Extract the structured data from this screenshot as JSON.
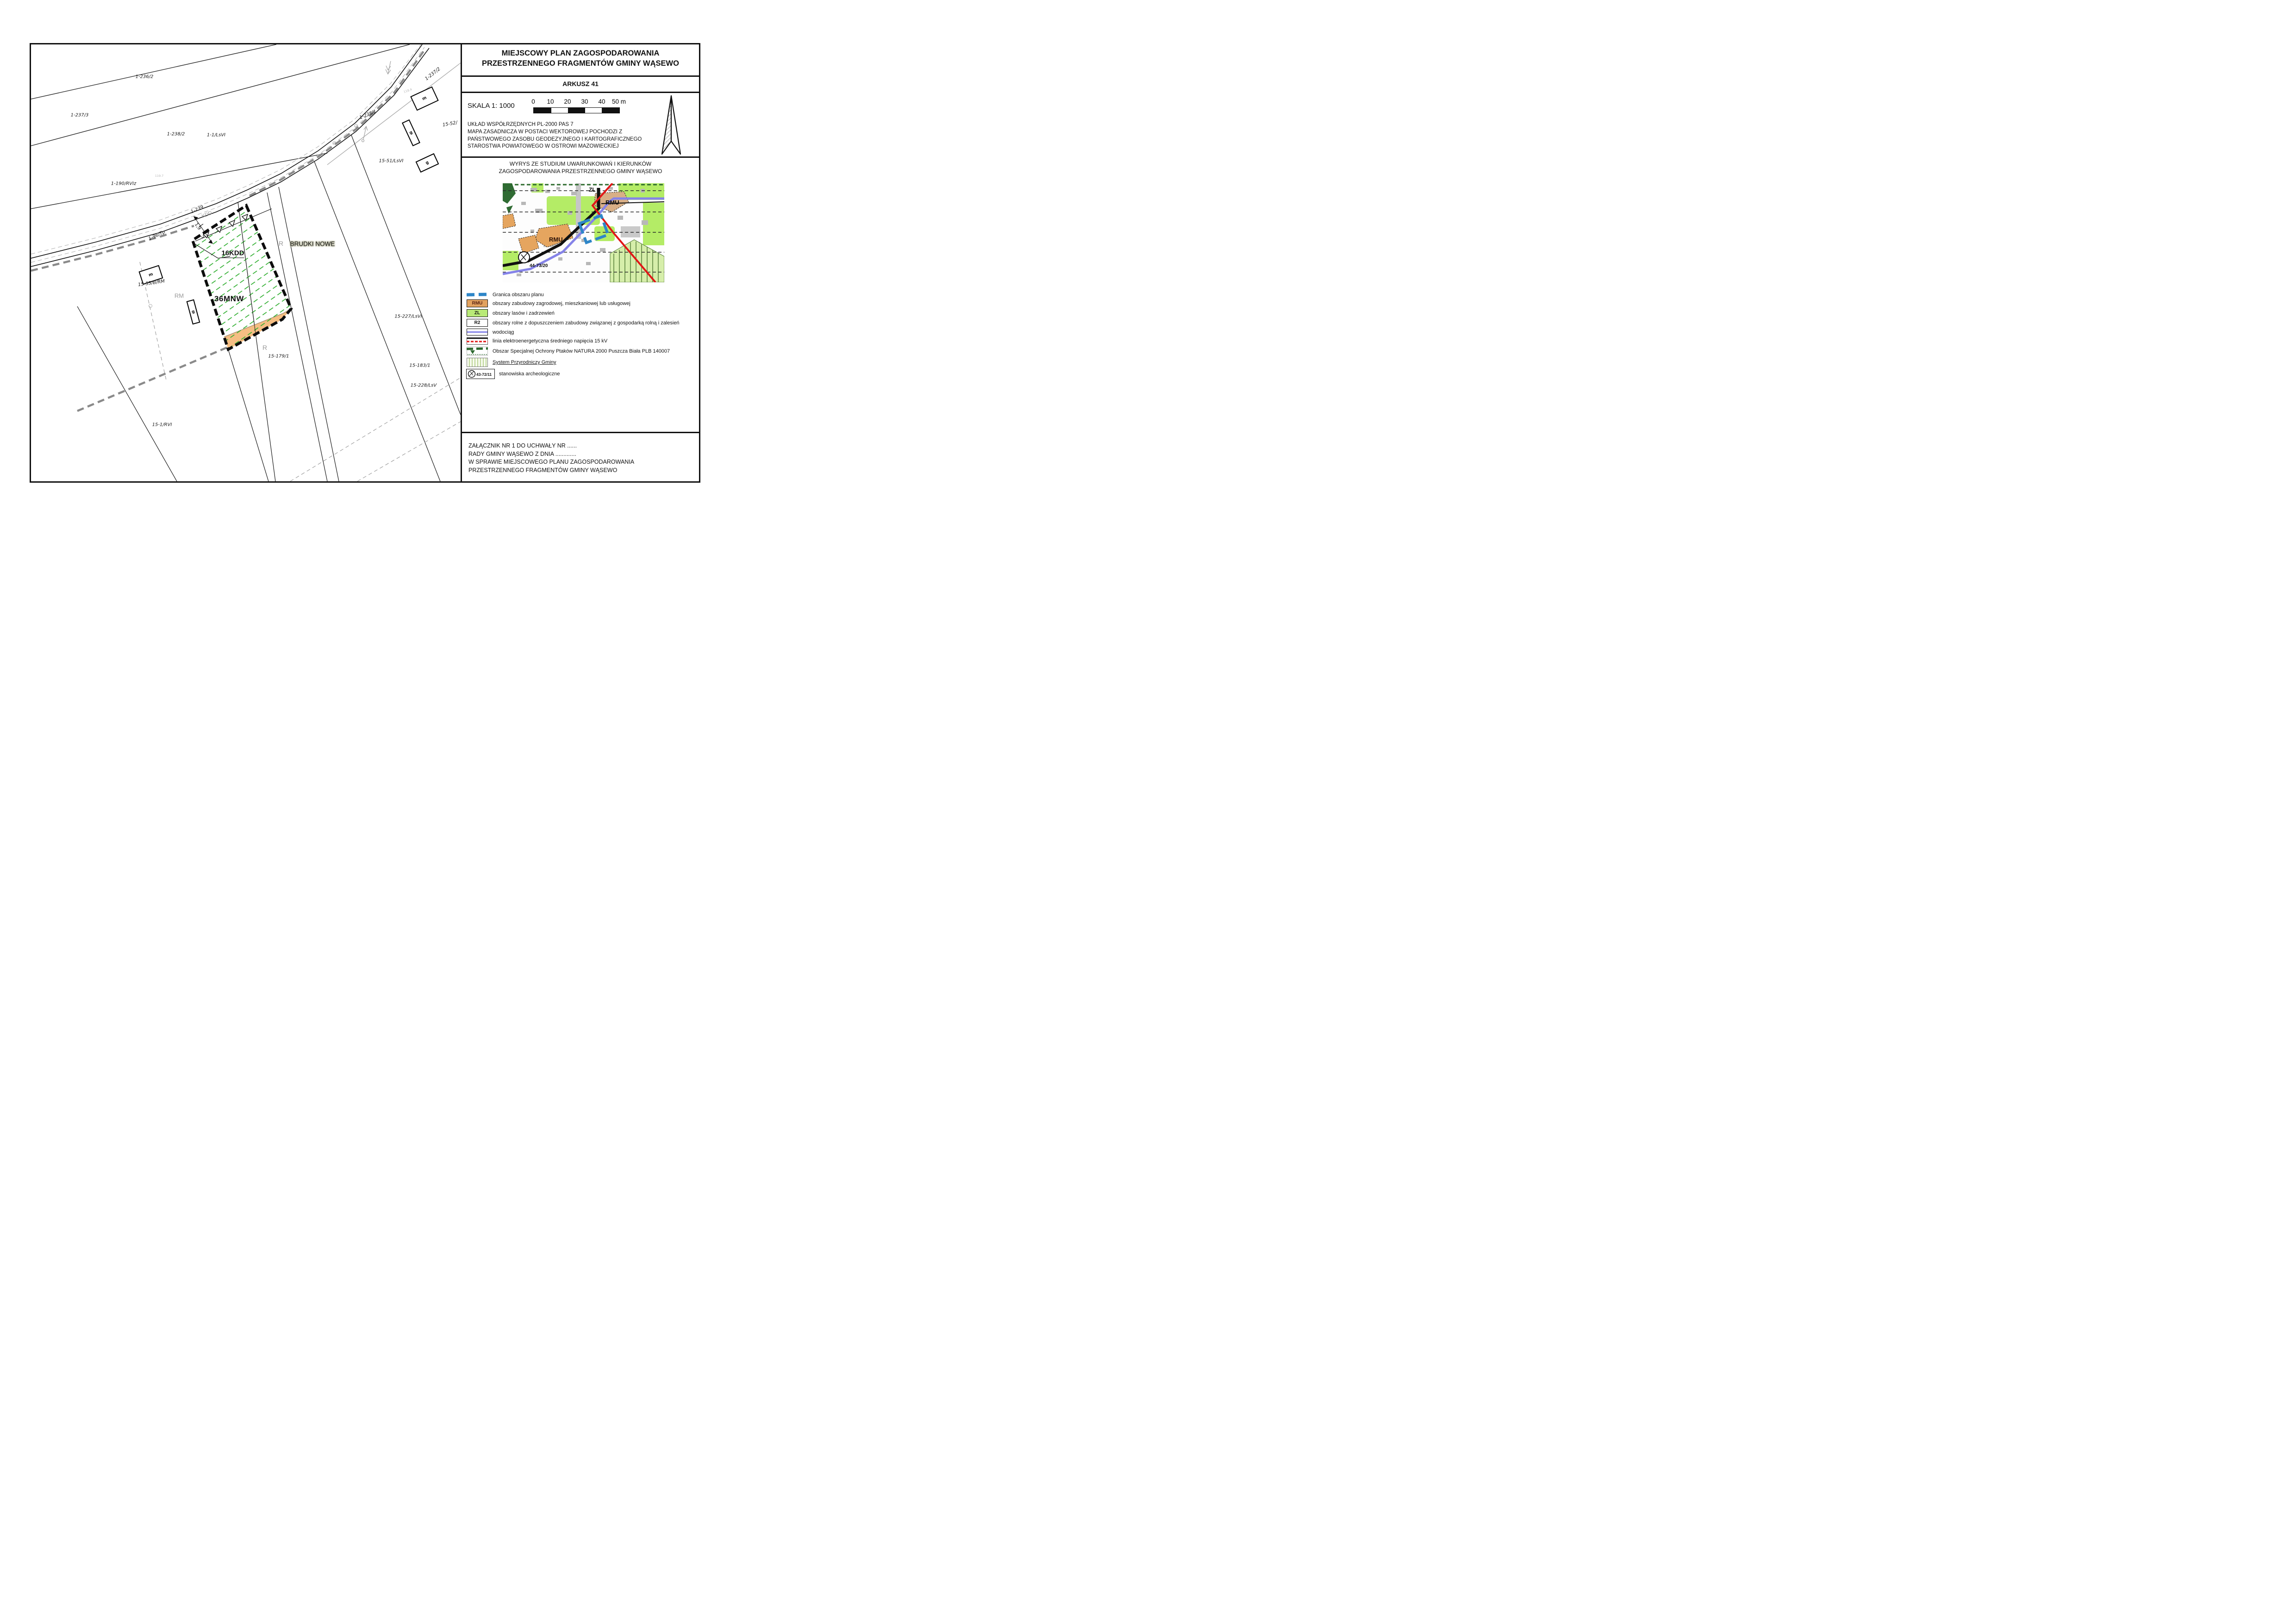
{
  "sheet": {
    "title_line1": "MIEJSCOWY PLAN ZAGOSPODAROWANIA",
    "title_line2": "PRZESTRZENNEGO FRAGMENTÓW GMINY WĄSEWO",
    "sheet_label": "ARKUSZ 41",
    "scale": {
      "label": "SKALA 1: 1000",
      "ticks": [
        "0",
        "10",
        "20",
        "30",
        "40",
        "50 m"
      ]
    },
    "source_lines": [
      "UKŁAD WSPÓŁRZĘDNYCH PL-2000 PAS 7",
      "MAPA ZASADNICZA W POSTACI WEKTOROWEJ POCHODZI Z",
      "PAŃSTWOWEGO ZASOBU GEODEZYJNEGO I KARTOGRAFICZNEGO",
      "STAROSTWA POWIATOWEGO W OSTROWI MAZOWIECKIEJ"
    ],
    "wyrys_line1": "WYRYS ZE STUDIUM UWARUNKOWAŃ I KIERUNKÓW",
    "wyrys_line2": "ZAGOSPODAROWANIA PRZESTRZENNEGO GMINY WĄSEWO",
    "inset": {
      "zl": "ZL",
      "rmu_left": "RMU",
      "rmu_right": "RMU",
      "arch_ref": "44-73/20"
    },
    "legend": [
      {
        "code": "",
        "label": "Granica obszaru planu"
      },
      {
        "code": "RMU",
        "label": "obszary zabudowy zagrodowej, mieszkaniowej lub usługowej"
      },
      {
        "code": "ZL",
        "label": "obszary lasów i zadrzewień"
      },
      {
        "code": "R2",
        "label": "obszary rolne z dopuszczeniem zabudowy związanej z gospodarką rolną i zalesień"
      },
      {
        "code": "",
        "label": "wodociąg"
      },
      {
        "code": "",
        "label": "linia elektroenergetyczna średniego napięcia 15 kV"
      },
      {
        "code": "",
        "label": "Obszar Specjalnej Ochrony Ptaków NATURA 2000 Puszcza Biała PLB 140007"
      },
      {
        "code": "",
        "label": "System Przyrodniczy Gminy"
      },
      {
        "code": "43-72/11",
        "label": "stanowiska archeologiczne"
      }
    ],
    "footer_lines": [
      "ZAŁĄCZNIK NR 1 DO UCHWAŁY NR ......",
      "RADY GMINY WĄSEWO Z DNIA .............",
      "W SPRAWIE MIEJSCOWEGO PLANU ZAGOSPODAROWANIA",
      "PRZESTRZENNEGO FRAGMENTÓW GMINY WĄSEWO"
    ]
  },
  "map": {
    "zone": {
      "kdd": "16KDD",
      "mnw": "36MNW"
    },
    "place": "BRUDKI NOWE",
    "dims": [
      "1,9",
      "5"
    ],
    "buildings": [
      "m",
      "g",
      "m",
      "g",
      "g"
    ],
    "elev": [
      "119.7",
      "118.4"
    ],
    "gray": [
      {
        "text": "KDD"
      },
      {
        "text": "RM"
      },
      {
        "text": "R"
      },
      {
        "text": "R"
      }
    ],
    "parcels": [
      {
        "text": "1-236/2"
      },
      {
        "text": "1-237/3"
      },
      {
        "text": "1-238/2"
      },
      {
        "text": "1-1/LsVI"
      },
      {
        "text": "1-190/RVIz"
      },
      {
        "text": "1-96/Tp"
      },
      {
        "text": "1-239"
      },
      {
        "text": "1-237/2"
      },
      {
        "text": "1-238/1"
      },
      {
        "text": "15-52/"
      },
      {
        "text": "15-51/LsVI"
      },
      {
        "text": "15-53/B/RM"
      },
      {
        "text": "15-227/LsVI"
      },
      {
        "text": "15-179/1"
      },
      {
        "text": "15-183/1"
      },
      {
        "text": "15-228/LsV"
      },
      {
        "text": "15-1/RVI"
      }
    ]
  },
  "colors": {
    "hatch_green": "#2fae2f",
    "plan_orange": "#f5be83",
    "boundary_blue": "#2e86c8",
    "wodociag_purple": "#8583e8",
    "power_red": "#e11717",
    "inset_green": "#b4ec66",
    "gray_boundary": "#8a8a8a"
  }
}
